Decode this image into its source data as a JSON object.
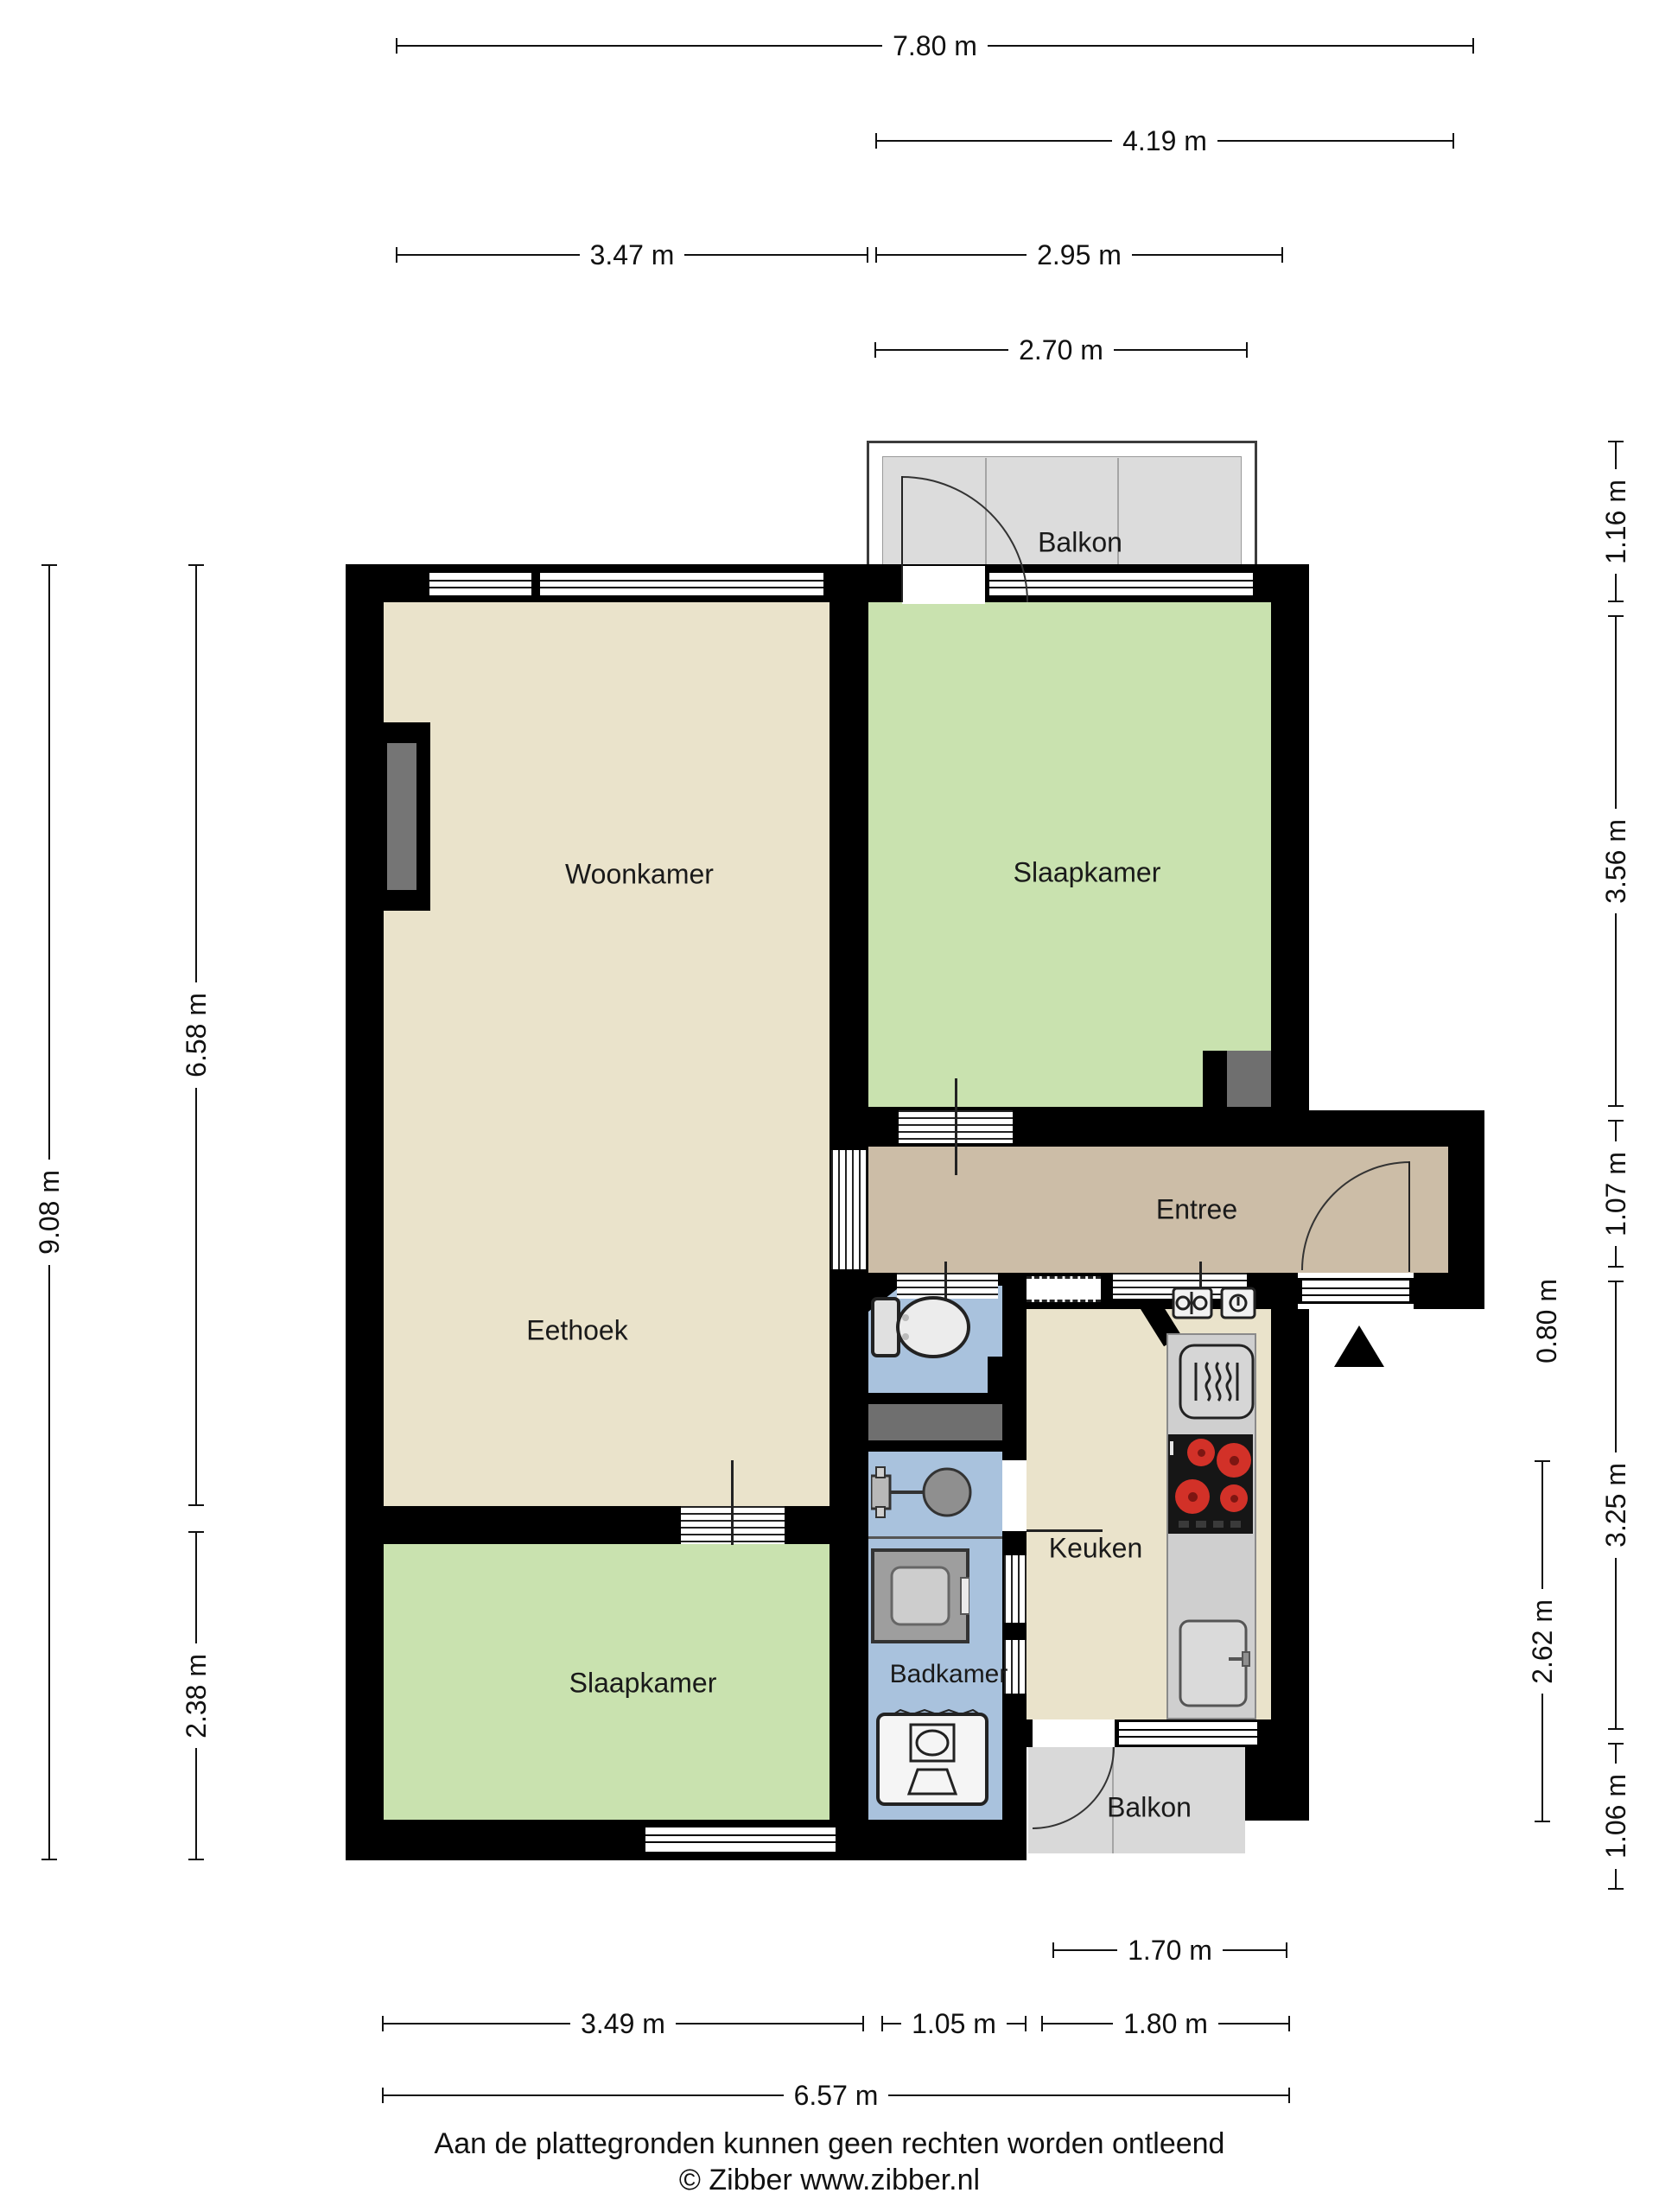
{
  "rooms": {
    "balkon_top": "Balkon",
    "woonkamer": "Woonkamer",
    "slaapkamer_rechts": "Slaapkamer",
    "entree": "Entree",
    "eethoek": "Eethoek",
    "keuken": "Keuken",
    "slaapkamer_links": "Slaapkamer",
    "badkamer": "Badkamer",
    "balkon_onder": "Balkon"
  },
  "dimensions": {
    "top": [
      "7.80 m",
      "4.19 m",
      "3.47 m",
      "2.95 m",
      "2.70 m"
    ],
    "left": [
      "9.08 m",
      "6.58 m",
      "2.38 m"
    ],
    "right": [
      "1.16 m",
      "3.56 m",
      "1.07 m",
      "0.80 m",
      "3.25 m",
      "2.62 m",
      "1.06 m"
    ],
    "bottom": [
      "1.70 m",
      "3.49 m",
      "1.05 m",
      "1.80 m",
      "6.57 m"
    ]
  },
  "footer": {
    "disclaimer": "Aan de plattegronden kunnen geen rechten worden ontleend",
    "credit": "© Zibber www.zibber.nl"
  },
  "icons": [
    "north-arrow",
    "toilet",
    "washbasin",
    "shower",
    "washing-machine",
    "oven",
    "cooktop",
    "kitchen-sink",
    "small-appliances",
    "door-swing"
  ],
  "colors": {
    "wall": "#000000",
    "living": "#eae3cb",
    "bedroom": "#c9e2af",
    "entry": "#ccbda7",
    "wet_room": "#a9c2dd",
    "balcony": "#dcdcdc",
    "shaft": "#6f6f6f",
    "counter": "#cfcfcf",
    "burner": "#d23128"
  }
}
